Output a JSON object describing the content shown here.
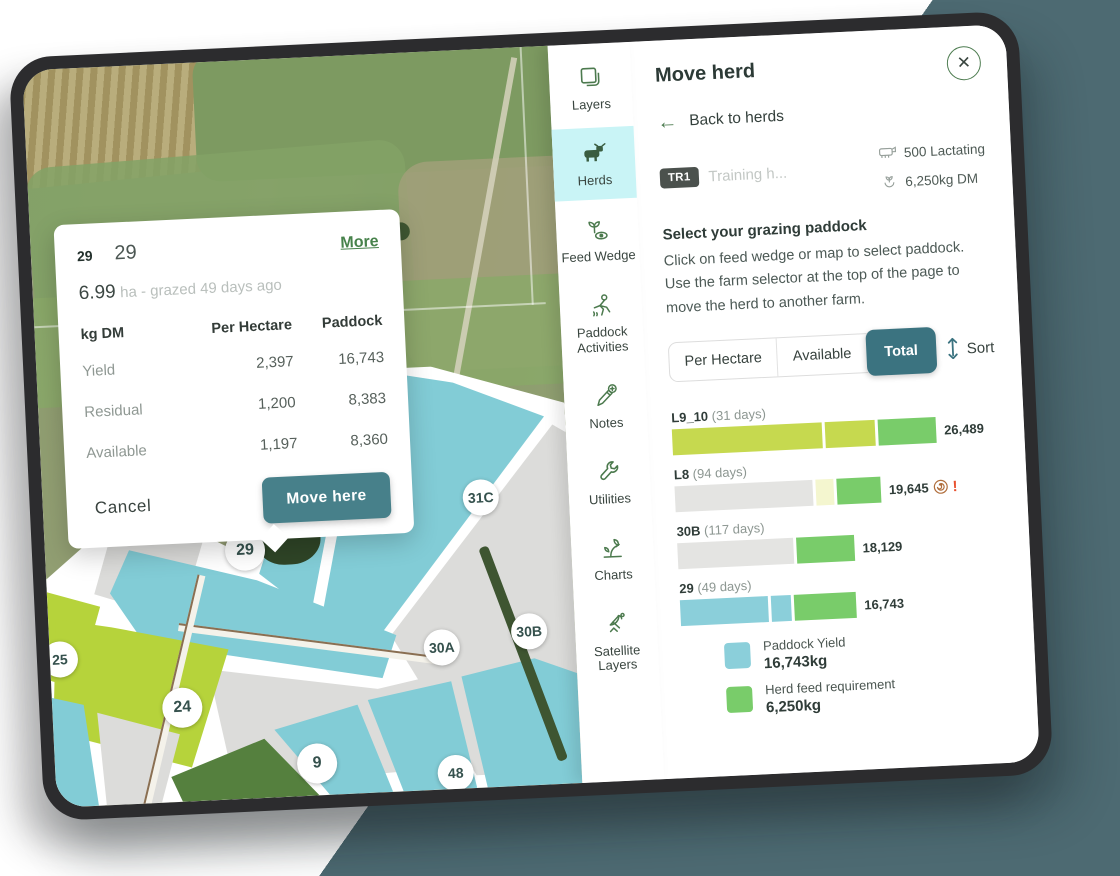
{
  "map": {
    "popup": {
      "badge": "29",
      "title": "29",
      "more_link": "More",
      "area": "6.99",
      "area_note": "ha - grazed 49 days ago",
      "table": {
        "headers": [
          "kg DM",
          "Per Hectare",
          "Paddock"
        ],
        "rows": [
          {
            "label": "Yield",
            "per_hectare": "2,397",
            "paddock": "16,743"
          },
          {
            "label": "Residual",
            "per_hectare": "1,200",
            "paddock": "8,383"
          },
          {
            "label": "Available",
            "per_hectare": "1,197",
            "paddock": "8,360"
          }
        ]
      },
      "cancel_label": "Cancel",
      "move_here_label": "Move here"
    },
    "paddock_labels": [
      "31B",
      "31C",
      "29",
      "30A",
      "30B",
      "25",
      "24",
      "9",
      "48"
    ]
  },
  "sidebar": {
    "items": [
      {
        "label": "Layers",
        "icon": "layers",
        "active": false
      },
      {
        "label": "Herds",
        "icon": "herds",
        "active": true
      },
      {
        "label": "Feed Wedge",
        "icon": "feed-wedge",
        "active": false
      },
      {
        "label": "Paddock Activities",
        "icon": "paddock-activities",
        "active": false
      },
      {
        "label": "Notes",
        "icon": "notes",
        "active": false
      },
      {
        "label": "Utilities",
        "icon": "utilities",
        "active": false
      },
      {
        "label": "Charts",
        "icon": "charts",
        "active": false
      },
      {
        "label": "Satellite Layers",
        "icon": "satellite-layers",
        "active": false
      }
    ]
  },
  "panel": {
    "title": "Move herd",
    "back_label": "Back to herds",
    "herd": {
      "badge": "TR1",
      "name": "Training h...",
      "stock_count": "500 Lactating",
      "feed_requirement": "6,250kg DM"
    },
    "instructions": {
      "heading": "Select your grazing paddock",
      "body": "Click on feed wedge or map to select paddock. Use the farm selector at the top of the page to move the herd to another farm."
    },
    "tabs": [
      {
        "label": "Per Hectare",
        "active": false
      },
      {
        "label": "Available",
        "active": false
      },
      {
        "label": "Total",
        "active": true
      }
    ],
    "sort_label": "Sort",
    "chart_data": {
      "type": "bar",
      "orientation": "horizontal",
      "unit": "kg DM",
      "title": "Feed wedge - paddock totals",
      "bars": [
        {
          "paddock": "L9_10",
          "days_label": "(31 days)",
          "days": 31,
          "total": 26489,
          "display_total": "26,489",
          "alert": false,
          "segments": [
            {
              "kind": "pasture-cover",
              "color": "#c6d94f",
              "len": 150
            },
            {
              "kind": "pasture-cover",
              "color": "#c6d94f",
              "len": 50
            },
            {
              "kind": "herd-feed-requirement",
              "color": "#79cc6a",
              "len": 58
            }
          ]
        },
        {
          "paddock": "L8",
          "days_label": "(94 days)",
          "days": 94,
          "total": 19645,
          "display_total": "19,645",
          "alert": true,
          "segments": [
            {
              "kind": "grazed",
              "color": "#e4e4e2",
              "len": 138
            },
            {
              "kind": "buffer",
              "color": "#f4f6cf",
              "len": 18
            },
            {
              "kind": "herd-feed-requirement",
              "color": "#79cc6a",
              "len": 44
            }
          ]
        },
        {
          "paddock": "30B",
          "days_label": "(117 days)",
          "days": 117,
          "total": 18129,
          "display_total": "18,129",
          "alert": false,
          "segments": [
            {
              "kind": "grazed",
              "color": "#e4e4e2",
              "len": 116
            },
            {
              "kind": "herd-feed-requirement",
              "color": "#79cc6a",
              "len": 58
            }
          ]
        },
        {
          "paddock": "29",
          "days_label": "(49 days)",
          "days": 49,
          "total": 16743,
          "display_total": "16,743",
          "alert": false,
          "segments": [
            {
              "kind": "paddock-yield",
              "color": "#8bcfda",
              "len": 88
            },
            {
              "kind": "paddock-yield",
              "color": "#8bcfda",
              "len": 20
            },
            {
              "kind": "herd-feed-requirement",
              "color": "#79cc6a",
              "len": 62
            }
          ]
        }
      ],
      "legend": [
        {
          "label": "Paddock Yield",
          "value": "16,743kg",
          "color": "#8bcfda"
        },
        {
          "label": "Herd feed requirement",
          "value": "6,250kg",
          "color": "#79cc6a"
        }
      ]
    }
  },
  "colors": {
    "accent_teal": "#3b7380",
    "button_teal": "#47808a",
    "sidebar_active_bg": "#c9f4f6",
    "link_green": "#47824b",
    "icon_green": "#4c7a4e",
    "alert_red": "#e8502e",
    "bale_brown": "#b06e3c",
    "background_teal": "#4d6a72",
    "paddock_teal": "#82ccd6",
    "paddock_lime": "#b6d33b",
    "paddock_grey": "#dcdcda",
    "paddock_dark_green": "#55803e"
  }
}
